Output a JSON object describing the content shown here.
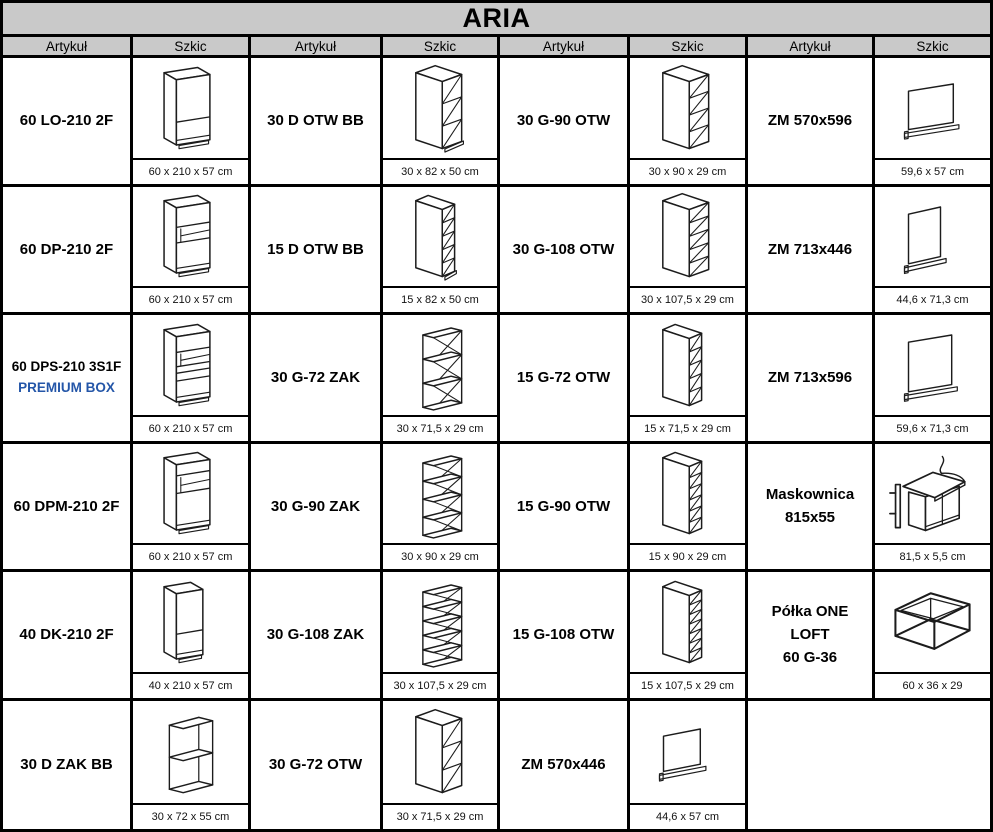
{
  "title": "ARIA",
  "header": {
    "artykul": "Artykuł",
    "szkic": "Szkic"
  },
  "colors": {
    "header_bg": "#c9c9c9",
    "border": "#000000",
    "premium_text": "#2456a8",
    "sketch_stroke": "#1c1c1c"
  },
  "rows": [
    [
      {
        "article": "60 LO-210 2F",
        "sketch": "tall-cabinet-2f",
        "dim": "60 x 210 x 57 cm"
      },
      {
        "article": "30 D OTW BB",
        "sketch": "base-open-shelf-30",
        "dim": "30 x 82 x 50 cm"
      },
      {
        "article": "30 G-90 OTW",
        "sketch": "wall-open-4",
        "dim": "30 x 90 x 29 cm"
      },
      {
        "article": "ZM 570x596",
        "sketch": "panel-570x596",
        "dim": "59,6 x 57 cm"
      }
    ],
    [
      {
        "article": "60 DP-210 2F",
        "sketch": "tall-cabinet-oven",
        "dim": "60 x 210 x 57 cm"
      },
      {
        "article": "15 D OTW BB",
        "sketch": "base-open-shelf-15",
        "dim": "15 x 82 x 50 cm"
      },
      {
        "article": "30 G-108 OTW",
        "sketch": "wall-open-5",
        "dim": "30 x 107,5 x 29 cm"
      },
      {
        "article": "ZM 713x446",
        "sketch": "panel-713x446",
        "dim": "44,6 x 71,3 cm"
      }
    ],
    [
      {
        "article": "60 DPS-210 3S1F",
        "article2": "PREMIUM BOX",
        "premium": true,
        "sketch": "tall-cabinet-oven-drawers",
        "dim": "60 x 210 x 57 cm"
      },
      {
        "article": "30 G-72 ZAK",
        "sketch": "corner-shelf-4",
        "dim": "30 x 71,5 x 29 cm"
      },
      {
        "article": "15 G-72 OTW",
        "sketch": "wall-narrow-5",
        "dim": "15 x 71,5 x 29 cm"
      },
      {
        "article": "ZM 713x596",
        "sketch": "panel-713x596",
        "dim": "59,6 x 71,3 cm"
      }
    ],
    [
      {
        "article": "60 DPM-210 2F",
        "sketch": "tall-cabinet-micro",
        "dim": "60 x 210 x 57 cm"
      },
      {
        "article": "30 G-90 ZAK",
        "sketch": "corner-shelf-5",
        "dim": "30 x 90 x 29 cm"
      },
      {
        "article": "15 G-90 OTW",
        "sketch": "wall-narrow-6",
        "dim": "15 x 90 x 29 cm"
      },
      {
        "article": "Maskownica",
        "article2": "815x55",
        "sketch": "maskownica",
        "dim": "81,5 x 5,5 cm"
      }
    ],
    [
      {
        "article": "40 DK-210 2F",
        "sketch": "tall-cabinet-narrow-2f",
        "dim": "40 x 210 x 57 cm"
      },
      {
        "article": "30 G-108 ZAK",
        "sketch": "corner-shelf-6",
        "dim": "30 x 107,5 x 29 cm"
      },
      {
        "article": "15 G-108 OTW",
        "sketch": "wall-narrow-7",
        "dim": "15 x 107,5 x 29 cm"
      },
      {
        "article": "Półka ONE LOFT",
        "article2": "60 G-36",
        "sketch": "loft-frame",
        "dim": "60 x 36 x 29"
      }
    ],
    [
      {
        "article": "30 D ZAK BB",
        "sketch": "corner-open-base",
        "dim": "30 x 72 x 55 cm"
      },
      {
        "article": "30 G-72 OTW",
        "sketch": "wall-open-3",
        "dim": "30 x 71,5 x 29 cm"
      },
      {
        "article": "ZM 570x446",
        "sketch": "panel-570x446",
        "dim": "44,6 x 57 cm"
      },
      null
    ]
  ]
}
